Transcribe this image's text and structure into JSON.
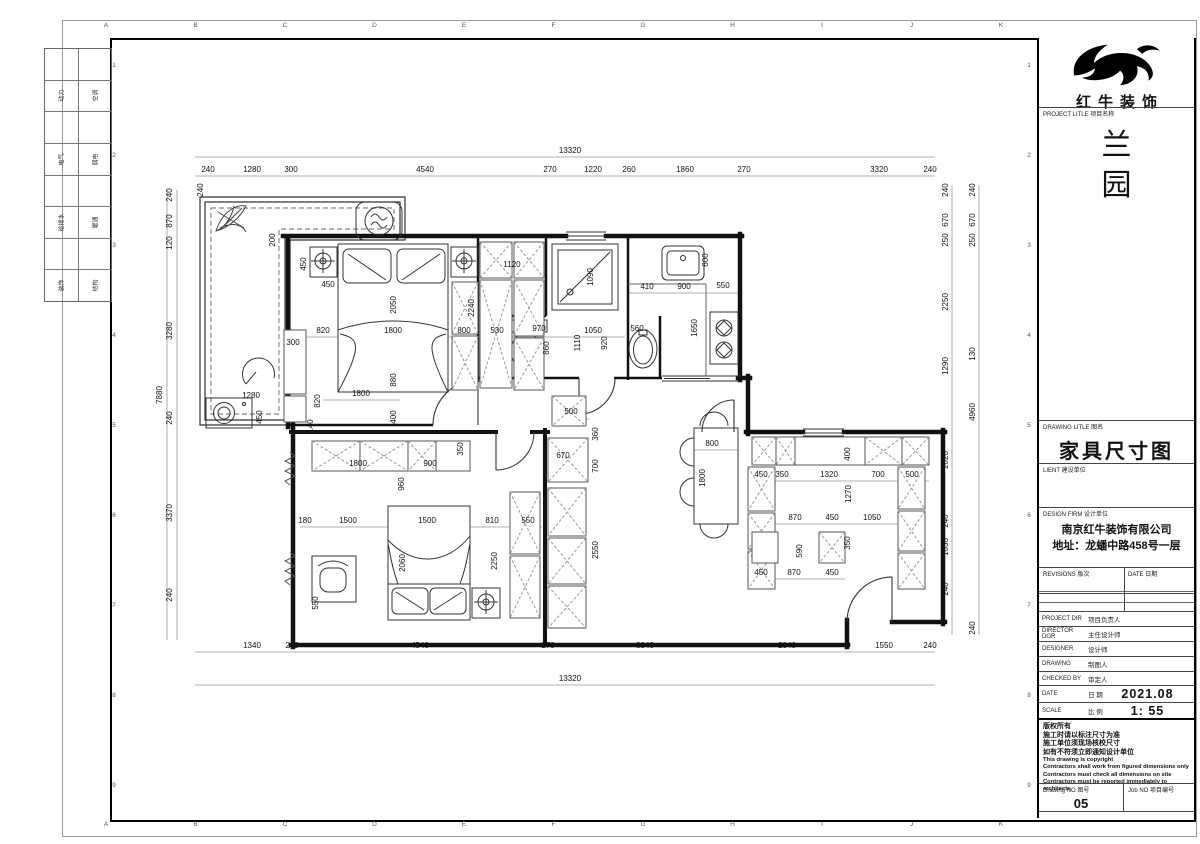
{
  "sheet": {
    "grid_letters": [
      "A",
      "B",
      "C",
      "D",
      "E",
      "F",
      "G",
      "H",
      "I",
      "J",
      "K"
    ],
    "grid_numbers": [
      "1",
      "2",
      "3",
      "4",
      "5",
      "6",
      "7",
      "8",
      "9"
    ],
    "stamp_rows": [
      [
        "动力",
        "空调"
      ],
      [
        "电气",
        "弱电"
      ],
      [
        "给排水",
        "暖通"
      ],
      [
        "装饰",
        "结构"
      ]
    ]
  },
  "title_block": {
    "logo_text": "红牛装饰",
    "project_label": "PROJECT LITLE  项目名称",
    "project_name_lines": [
      "兰",
      "园"
    ],
    "drawing_title_label": "DRAWING LITLE  图名",
    "drawing_title": "家具尺寸图",
    "client_label": "LIENT  建设单位",
    "design_firm_label": "DESIGN FIRM  设计单位",
    "design_firm_name": "南京红牛装饰有限公司",
    "design_firm_address": "地址：龙蟠中路458号一层",
    "revisions_label": "REVISIONS  版次",
    "revisions_date_label": "DATE  日期",
    "rows": [
      {
        "en": "PROJECT DIR",
        "cn": "项目负责人",
        "val": ""
      },
      {
        "en": "DIRECTOR DGR",
        "cn": "主任设计师",
        "val": ""
      },
      {
        "en": "DESIGNER",
        "cn": "设计师",
        "val": ""
      },
      {
        "en": "DRAWING",
        "cn": "制图人",
        "val": ""
      },
      {
        "en": "CHECKED BY",
        "cn": "审定人",
        "val": ""
      },
      {
        "en": "DATE",
        "cn": "日 期",
        "val": "2021.08"
      },
      {
        "en": "SCALE",
        "cn": "比 例",
        "val": "1: 55"
      }
    ],
    "notes_cn": [
      "版权所有",
      "施工时请以标注尺寸为准",
      "施工单位须现场核校尺寸",
      "如有不符须立即通知设计单位"
    ],
    "notes_en": [
      "This drawing is copyright",
      "Contractors shall work from figured dimensions only",
      "Contractors must check all dimensions on site",
      "Contractors must be reported immediately to architects"
    ],
    "drawing_no_label": "Drawing NO  图号",
    "drawing_no": "05",
    "job_no_label": "Job NO  项目编号",
    "job_no": ""
  },
  "plan": {
    "dim_labels": [
      [
        "13320",
        570,
        153,
        0
      ],
      [
        "240",
        208,
        172,
        0
      ],
      [
        "1280",
        252,
        172,
        0
      ],
      [
        "300",
        291,
        172,
        0
      ],
      [
        "4540",
        425,
        172,
        0
      ],
      [
        "270",
        550,
        172,
        0
      ],
      [
        "1220",
        593,
        172,
        0
      ],
      [
        "260",
        629,
        172,
        0
      ],
      [
        "1860",
        685,
        172,
        0
      ],
      [
        "270",
        744,
        172,
        0
      ],
      [
        "3320",
        879,
        172,
        0
      ],
      [
        "240",
        930,
        172,
        0
      ],
      [
        "1340",
        252,
        648,
        0
      ],
      [
        "240",
        292,
        648,
        0
      ],
      [
        "4540",
        420,
        648,
        0
      ],
      [
        "270",
        548,
        648,
        0
      ],
      [
        "3340",
        645,
        648,
        0
      ],
      [
        "2040",
        787,
        648,
        0
      ],
      [
        "1550",
        884,
        648,
        0
      ],
      [
        "240",
        930,
        648,
        0
      ],
      [
        "13320",
        570,
        681,
        0
      ],
      [
        "240",
        172,
        195,
        1
      ],
      [
        "870",
        172,
        221,
        1
      ],
      [
        "120",
        172,
        243,
        1
      ],
      [
        "3280",
        172,
        331,
        1
      ],
      [
        "240",
        172,
        418,
        1
      ],
      [
        "3370",
        172,
        513,
        1
      ],
      [
        "240",
        172,
        595,
        1
      ],
      [
        "7880",
        162,
        395,
        1
      ],
      [
        "240",
        203,
        190,
        1
      ],
      [
        "240",
        948,
        190,
        1
      ],
      [
        "670",
        948,
        220,
        1
      ],
      [
        "250",
        948,
        240,
        1
      ],
      [
        "2250",
        948,
        302,
        1
      ],
      [
        "1290",
        948,
        366,
        1
      ],
      [
        "2020",
        948,
        460,
        1
      ],
      [
        "240",
        948,
        521,
        1
      ],
      [
        "1030",
        948,
        547,
        1
      ],
      [
        "240",
        948,
        589,
        1
      ],
      [
        "240",
        975,
        190,
        1
      ],
      [
        "670",
        975,
        220,
        1
      ],
      [
        "250",
        975,
        240,
        1
      ],
      [
        "130",
        975,
        354,
        1
      ],
      [
        "4960",
        975,
        412,
        1
      ],
      [
        "240",
        975,
        628,
        1
      ],
      [
        "200",
        275,
        240,
        1
      ],
      [
        "450",
        306,
        264,
        1
      ],
      [
        "450",
        328,
        287,
        0
      ],
      [
        "2050",
        396,
        305,
        1
      ],
      [
        "2240",
        474,
        308,
        1
      ],
      [
        "820",
        323,
        333,
        0
      ],
      [
        "1800",
        393,
        333,
        0
      ],
      [
        "800",
        464,
        333,
        0
      ],
      [
        "300",
        293,
        345,
        0
      ],
      [
        "880",
        396,
        380,
        1
      ],
      [
        "1800",
        361,
        396,
        0
      ],
      [
        "820",
        320,
        401,
        1
      ],
      [
        "400",
        396,
        417,
        1
      ],
      [
        "140",
        313,
        426,
        1
      ],
      [
        "1280",
        251,
        398,
        0
      ],
      [
        "450",
        262,
        417,
        1
      ],
      [
        "1120",
        512,
        267,
        0
      ],
      [
        "1090",
        593,
        277,
        1
      ],
      [
        "530",
        497,
        333,
        0
      ],
      [
        "970",
        539,
        331,
        0
      ],
      [
        "860",
        549,
        348,
        1
      ],
      [
        "1110",
        580,
        343,
        1
      ],
      [
        "1050",
        593,
        333,
        0
      ],
      [
        "920",
        607,
        343,
        1
      ],
      [
        "560",
        637,
        331,
        0
      ],
      [
        "410",
        647,
        289,
        0
      ],
      [
        "900",
        684,
        289,
        0
      ],
      [
        "550",
        723,
        288,
        0
      ],
      [
        "600",
        708,
        260,
        1
      ],
      [
        "1650",
        697,
        328,
        1
      ],
      [
        "500",
        571,
        414,
        0
      ],
      [
        "360",
        598,
        434,
        1
      ],
      [
        "670",
        563,
        458,
        0
      ],
      [
        "700",
        598,
        466,
        1
      ],
      [
        "2550",
        598,
        550,
        1
      ],
      [
        "800",
        712,
        446,
        0
      ],
      [
        "1800",
        705,
        478,
        1
      ],
      [
        "400",
        850,
        454,
        1
      ],
      [
        "450",
        761,
        477,
        0
      ],
      [
        "350",
        782,
        477,
        0
      ],
      [
        "1320",
        829,
        477,
        0
      ],
      [
        "700",
        878,
        477,
        0
      ],
      [
        "500",
        912,
        477,
        0
      ],
      [
        "1270",
        851,
        494,
        1
      ],
      [
        "870",
        795,
        520,
        0
      ],
      [
        "450",
        832,
        520,
        0
      ],
      [
        "1050",
        872,
        520,
        0
      ],
      [
        "590",
        802,
        551,
        1
      ],
      [
        "350",
        850,
        543,
        1
      ],
      [
        "450",
        761,
        575,
        0
      ],
      [
        "870",
        794,
        575,
        0
      ],
      [
        "450",
        832,
        575,
        0
      ],
      [
        "350",
        463,
        449,
        1
      ],
      [
        "1800",
        358,
        466,
        0
      ],
      [
        "900",
        430,
        466,
        0
      ],
      [
        "960",
        404,
        484,
        1
      ],
      [
        "180",
        305,
        523,
        0
      ],
      [
        "1500",
        348,
        523,
        0
      ],
      [
        "1500",
        427,
        523,
        0
      ],
      [
        "810",
        492,
        523,
        0
      ],
      [
        "550",
        528,
        523,
        0
      ],
      [
        "2060",
        405,
        563,
        1
      ],
      [
        "2250",
        497,
        561,
        1
      ],
      [
        "550",
        318,
        603,
        1
      ]
    ]
  }
}
